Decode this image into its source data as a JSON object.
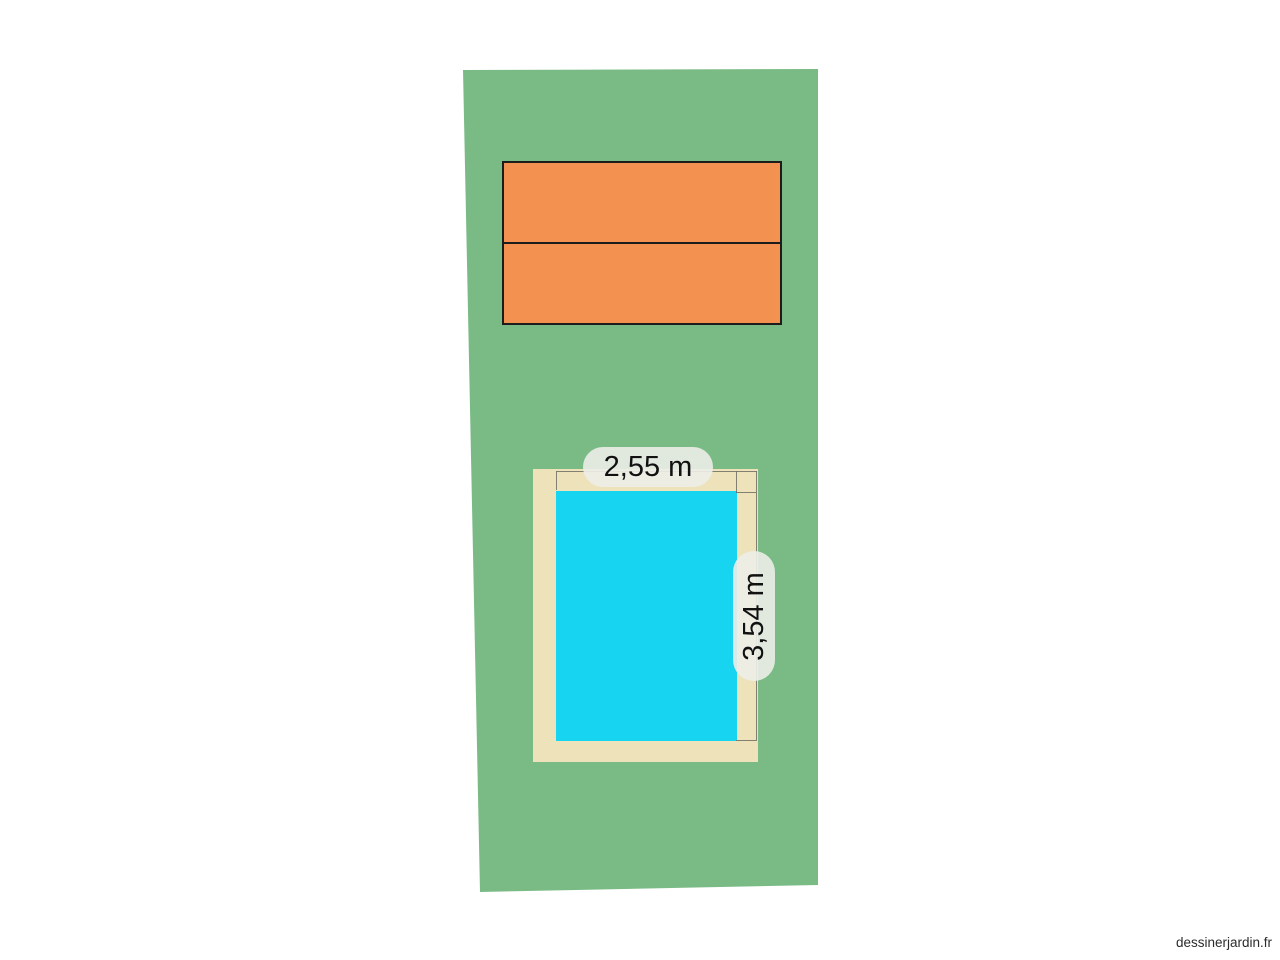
{
  "app": {
    "watermark": "dessinerjardin.fr"
  },
  "garden_plan": {
    "pool": {
      "width_label": "2,55 m",
      "height_label": "3,54 m"
    },
    "building": {
      "sections": 2
    }
  },
  "colors": {
    "canvas-bg": "#ffffff",
    "plot-green": "#7abb85",
    "building-orange": "#f39250",
    "building-border": "#1c1c1c",
    "pool-deck": "#ede2ba",
    "pool-water": "#17d4f1",
    "dim-line": "#6f6f64",
    "label-bg": "rgba(236,238,233,0.9)"
  }
}
